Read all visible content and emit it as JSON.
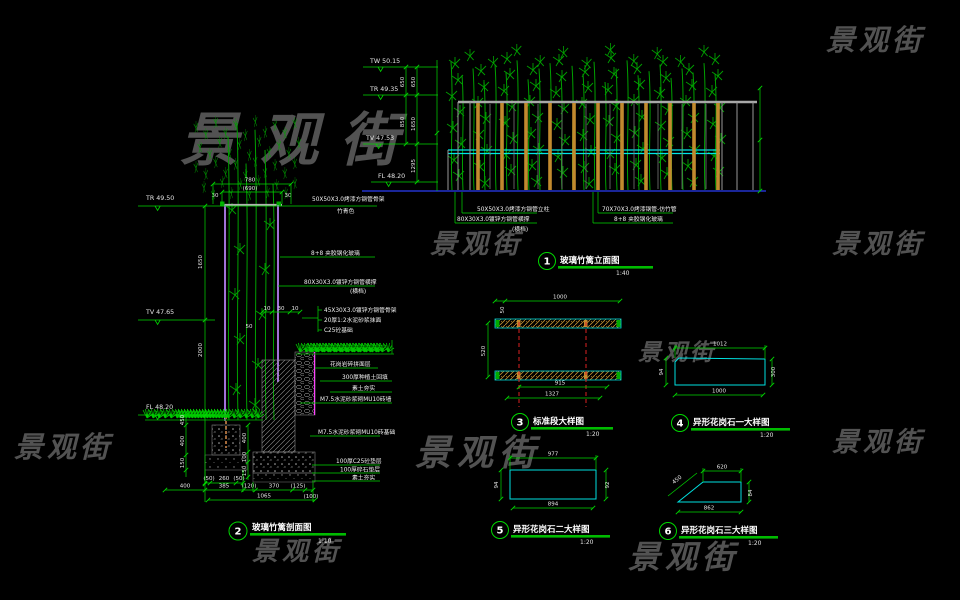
{
  "watermark": {
    "text": "景观街",
    "color": "#969696"
  },
  "titles": {
    "t1": {
      "num": "1",
      "label": "玻璃竹篱立面图",
      "scale": "1:40"
    },
    "t2": {
      "num": "2",
      "label": "玻璃竹篱剖面图",
      "scale": "1:10"
    },
    "t3": {
      "num": "3",
      "label": "标准段大样图",
      "scale": "1:20"
    },
    "t4": {
      "num": "4",
      "label": "异形花岗石一大样图",
      "scale": "1:20"
    },
    "t5": {
      "num": "5",
      "label": "异形花岗石二大样图",
      "scale": "1:20"
    },
    "t6": {
      "num": "6",
      "label": "异形花岗石三大样图",
      "scale": "1:20"
    }
  },
  "elevation": {
    "levels": {
      "l1": "TW 50.15",
      "l2": "TR 49.35",
      "l3": "TV 47.53",
      "l4": "FL 48.20"
    },
    "dims": {
      "a1": "650",
      "a2": "850",
      "b1": "650",
      "b2": "1650",
      "b3": "1295"
    },
    "notes": {
      "nl1": "50X50X3.0烤漆方钢管立柱",
      "nl2": "80X30X3.0镀锌方钢管横撑",
      "nl3": "(横档)",
      "nr1": "70X70X3.0烤漆钢管-仿竹管",
      "nr2": "8+8 夹胶钢化玻璃"
    }
  },
  "section": {
    "levels": {
      "tr": "TR 49.50",
      "tv": "TV 47.65",
      "fl": "FL 48.20"
    },
    "top_dims": {
      "total": "780",
      "inner": "(690)",
      "s1": "30",
      "s2": "30"
    },
    "left_dims": {
      "v1": "1650",
      "v2": "2000",
      "f1": "450",
      "f2": "400",
      "f3": "150"
    },
    "mid_dims": {
      "m1": "400",
      "m2": "100",
      "m3": "150",
      "g1": "10",
      "g2": "30",
      "g3": "10",
      "g4": "50"
    },
    "bottom_dims": {
      "a": "(50)",
      "b": "260",
      "c": "(50)",
      "r0": "400",
      "r1": "385",
      "r2": "(120)",
      "r3": "370",
      "r4": "(125)",
      "r5": "(100)",
      "total": "1065"
    },
    "notes": {
      "n1": "50X50X3.0烤漆方钢管骨架",
      "n2": "竹青色",
      "n3": "8+8 夹胶钢化玻璃",
      "n4": "80X30X3.0镀锌方钢管横撑",
      "n5": "(横档)",
      "n6": "45X30X3.0镀锌方钢管骨架",
      "n7": "20厚1:2水泥砂浆抹面",
      "n8": "C25砼基础",
      "n9": "花岗岩碎拼面层",
      "n10": "300厚种植土回填",
      "n11": "素土夯实",
      "n12": "M7.5水泥砂浆砌MU10砖墙",
      "n13": "M7.5水泥砂浆砌MU10砖基础",
      "n14": "100厚C25砼垫层",
      "n15": "100厚碎石垫层",
      "n16": "素土夯实"
    }
  },
  "detail3": {
    "dims": {
      "top": "1000",
      "s": "50",
      "left": "520",
      "b1": "915",
      "b2": "1327"
    }
  },
  "detail4": {
    "dims": {
      "top": "1012",
      "bottom": "1000",
      "left": "94",
      "right": "300"
    }
  },
  "detail5": {
    "dims": {
      "top": "977",
      "bottom": "894",
      "left": "94",
      "right": "92"
    }
  },
  "detail6": {
    "dims": {
      "top": "620",
      "diag": "450",
      "bottom": "862",
      "right": "84"
    }
  }
}
